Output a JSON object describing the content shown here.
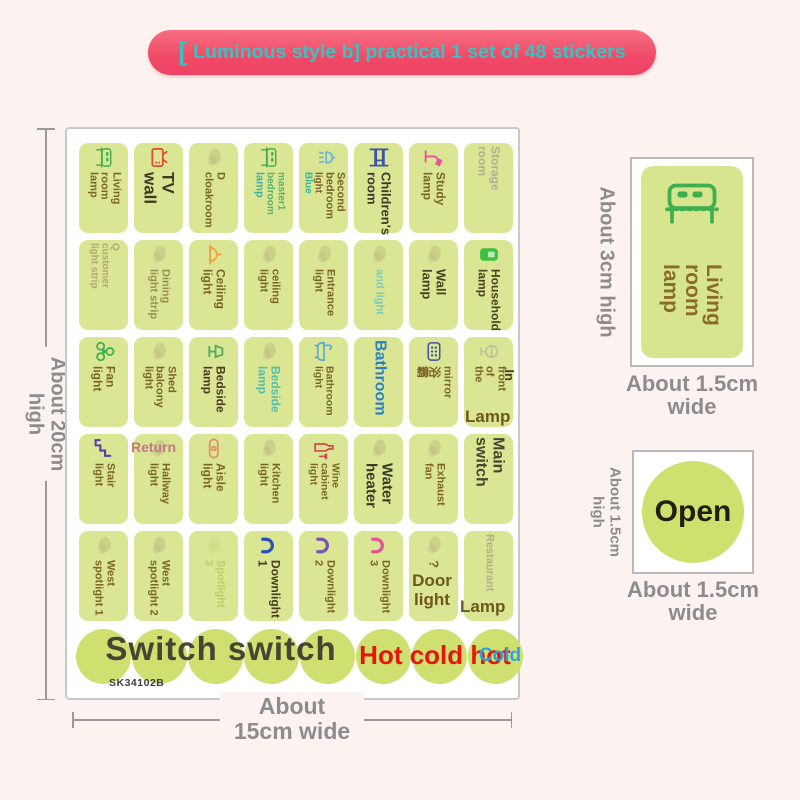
{
  "banner": {
    "bracket": "[",
    "text": "Luminous style b] practical 1 set of 48 stickers",
    "bg": "#ee4163",
    "fg": "#38c2c4"
  },
  "colors": {
    "sticker_bg": "#dae694",
    "circle_bg": "#cfe070",
    "brown": "#7c6426",
    "dark_overlay": "#3c3a26",
    "teal": "#3ab2a4",
    "blue": "#2e7fc0",
    "red": "#e2180e",
    "cold_blue": "#2aa3de",
    "dim_gray": "#8c8c8c"
  },
  "sheet": {
    "code": "SK34102B",
    "stickers": [
      {
        "icon": "bed-icon",
        "icon_color": "#3fae4e",
        "lines": [
          {
            "text": "Living",
            "color": "#7c6426",
            "size": 11
          },
          {
            "text": "room",
            "color": "#7c6426",
            "size": 11
          },
          {
            "text": "lamp",
            "color": "#7c6426",
            "size": 11
          }
        ]
      },
      {
        "icon": "tv-icon",
        "icon_color": "#df4b2d",
        "lines": [
          {
            "text": "TV",
            "color": "#3c3a26",
            "size": 17
          },
          {
            "text": "wall",
            "color": "#3c3a26",
            "size": 17
          }
        ]
      },
      {
        "icon": "faded-icon",
        "icon_color": "#b3a878",
        "lines": [
          {
            "text": "D",
            "color": "#7c6426",
            "size": 11
          },
          {
            "text": "cloakroom",
            "color": "#7c6426",
            "size": 11
          }
        ]
      },
      {
        "icon": "bed-icon",
        "icon_color": "#3fae4e",
        "lines": [
          {
            "text": "master1",
            "color": "#5fb06a",
            "size": 10
          },
          {
            "text": "bedroom",
            "color": "#5fb06a",
            "size": 10
          },
          {
            "text": "lamp",
            "color": "#3ab2a4",
            "size": 11
          }
        ]
      },
      {
        "icon": "shower-icon",
        "icon_color": "#6cb2dc",
        "lines": [
          {
            "text": "Second",
            "color": "#7c6426",
            "size": 11
          },
          {
            "text": "bedroom",
            "color": "#7c6426",
            "size": 11
          },
          {
            "text": "light",
            "color": "#7c6426",
            "size": 10
          },
          {
            "text": "Blue",
            "color": "#3ab2a4",
            "size": 10
          }
        ]
      },
      {
        "icon": "bunkbed-icon",
        "icon_color": "#3d55a8",
        "lines": [
          {
            "text": "Children's",
            "color": "#3c3a26",
            "size": 13
          },
          {
            "text": "room",
            "color": "#3c3a26",
            "size": 13
          }
        ]
      },
      {
        "icon": "desklamp-icon",
        "icon_color": "#e8559a",
        "lines": [
          {
            "text": "Study",
            "color": "#7c6426",
            "size": 12
          },
          {
            "text": "lamp",
            "color": "#7c6426",
            "size": 12
          }
        ]
      },
      {
        "icon": "none",
        "icon_color": "",
        "lines": [
          {
            "text": "Storage",
            "color": "#b5ae95",
            "size": 12
          },
          {
            "text": "room",
            "color": "#b5ae95",
            "size": 12
          }
        ]
      },
      {
        "icon": "none",
        "icon_color": "",
        "lines": [
          {
            "text": "Q",
            "color": "#b3a878",
            "size": 10
          },
          {
            "text": "customer",
            "color": "#b3a878",
            "size": 10
          },
          {
            "text": "light strip",
            "color": "#b3a878",
            "size": 10
          }
        ]
      },
      {
        "icon": "faded-icon",
        "icon_color": "#b3a878",
        "lines": [
          {
            "text": "Dining",
            "color": "#9d8d55",
            "size": 11
          },
          {
            "text": "light strip",
            "color": "#9d8d55",
            "size": 11
          }
        ]
      },
      {
        "icon": "ceilinglamp-icon",
        "icon_color": "#efa13b",
        "lines": [
          {
            "text": "Ceiling",
            "color": "#7c6426",
            "size": 12
          },
          {
            "text": "light",
            "color": "#7c6426",
            "size": 12
          }
        ]
      },
      {
        "icon": "faded-icon",
        "icon_color": "#b3a878",
        "lines": [
          {
            "text": "ceiling",
            "color": "#7c6426",
            "size": 11
          },
          {
            "text": "light",
            "color": "#7c6426",
            "size": 11
          }
        ]
      },
      {
        "icon": "faded-icon",
        "icon_color": "#b3a878",
        "lines": [
          {
            "text": "Entrance",
            "color": "#7c6426",
            "size": 11
          },
          {
            "text": "light",
            "color": "#7c6426",
            "size": 11
          }
        ]
      },
      {
        "icon": "faded-icon",
        "icon_color": "#b3a878",
        "lines": [
          {
            "text": "and light",
            "color": "#7fcabe",
            "size": 11
          }
        ]
      },
      {
        "icon": "faded-icon",
        "icon_color": "#b3a878",
        "lines": [
          {
            "text": "Wall",
            "color": "#4a3f23",
            "size": 13
          },
          {
            "text": "lamp",
            "color": "#4a3f23",
            "size": 13
          }
        ]
      },
      {
        "icon": "switch-icon",
        "icon_color": "#3fbf3f",
        "lines": [
          {
            "text": "Household",
            "color": "#4a3f23",
            "size": 12
          },
          {
            "text": "lamp",
            "color": "#4a3f23",
            "size": 12
          }
        ]
      },
      {
        "icon": "fan-icon",
        "icon_color": "#3fae4e",
        "lines": [
          {
            "text": "Fan",
            "color": "#7c6426",
            "size": 12
          },
          {
            "text": "light",
            "color": "#7c6426",
            "size": 12
          }
        ]
      },
      {
        "icon": "faded-icon",
        "icon_color": "#b3a878",
        "lines": [
          {
            "text": "Shed",
            "color": "#7c6426",
            "size": 11
          },
          {
            "text": "balcony",
            "color": "#7c6426",
            "size": 11
          },
          {
            "text": "light",
            "color": "#7c6426",
            "size": 11
          }
        ]
      },
      {
        "icon": "bedside-icon",
        "icon_color": "#4fae5e",
        "lines": [
          {
            "text": "Bedside",
            "color": "#4a3a20",
            "size": 12
          },
          {
            "text": "lamp",
            "color": "#4a3a20",
            "size": 12
          }
        ]
      },
      {
        "icon": "faded-icon",
        "icon_color": "#b3a878",
        "lines": [
          {
            "text": "Bedside",
            "color": "#52bfae",
            "size": 12
          },
          {
            "text": "lamp",
            "color": "#52bfae",
            "size": 12
          }
        ]
      },
      {
        "icon": "bathtub-icon",
        "icon_color": "#58a8d8",
        "lines": [
          {
            "text": "Bathroom",
            "color": "#7c6426",
            "size": 10.5
          },
          {
            "text": "light",
            "color": "#7c6426",
            "size": 10.5
          }
        ]
      },
      {
        "icon": "none",
        "icon_color": "",
        "lines": [
          {
            "text": "Bathroom",
            "color": "#2e7fc0",
            "size": 16
          }
        ]
      },
      {
        "icon": "heater-icon",
        "icon_color": "#3d55a8",
        "lines": [
          {
            "text": "mirror",
            "color": "#7c6426",
            "size": 11
          },
          {
            "text": "浴",
            "color": "#7c6426",
            "size": 12
          },
          {
            "text": "霸",
            "color": "#7c6426",
            "size": 12
          }
        ]
      },
      {
        "icon": "globe-icon",
        "icon_color": "#a9a49a",
        "lines": [
          {
            "text": "front",
            "color": "#7c6426",
            "size": 11
          },
          {
            "text": "of",
            "color": "#7c6426",
            "size": 11
          },
          {
            "text": "the",
            "color": "#7c6426",
            "size": 11
          }
        ]
      },
      {
        "icon": "stairs-icon",
        "icon_color": "#5b3da6",
        "lines": [
          {
            "text": "Stair",
            "color": "#7c6426",
            "size": 11
          },
          {
            "text": "light",
            "color": "#7c6426",
            "size": 11
          }
        ]
      },
      {
        "icon": "faded-icon",
        "icon_color": "#b3a878",
        "lines": [
          {
            "text": "Hallway",
            "color": "#7c6426",
            "size": 11
          },
          {
            "text": "light",
            "color": "#7c6426",
            "size": 11
          }
        ]
      },
      {
        "icon": "aisle-icon",
        "icon_color": "#e28d68",
        "lines": [
          {
            "text": "Aisle",
            "color": "#7c6426",
            "size": 12
          },
          {
            "text": "light",
            "color": "#7c6426",
            "size": 12
          }
        ]
      },
      {
        "icon": "faded-icon",
        "icon_color": "#b3a878",
        "lines": [
          {
            "text": "Kitchen",
            "color": "#7c6426",
            "size": 11
          },
          {
            "text": "light",
            "color": "#7c6426",
            "size": 11
          }
        ]
      },
      {
        "icon": "wine-icon",
        "icon_color": "#d4484f",
        "lines": [
          {
            "text": "Wine",
            "color": "#7c6426",
            "size": 10.5
          },
          {
            "text": "cabinet",
            "color": "#7c6426",
            "size": 10.5
          },
          {
            "text": "light",
            "color": "#7c6426",
            "size": 10.5
          }
        ]
      },
      {
        "icon": "faded-icon",
        "icon_color": "#b3a878",
        "lines": [
          {
            "text": "Water",
            "color": "#3c3a26",
            "size": 15
          },
          {
            "text": "heater",
            "color": "#3c3a26",
            "size": 15
          }
        ]
      },
      {
        "icon": "faded-icon",
        "icon_color": "#b3a878",
        "lines": [
          {
            "text": "Exhaust",
            "color": "#7c6426",
            "size": 11
          },
          {
            "text": "fan",
            "color": "#7c6426",
            "size": 11
          }
        ]
      },
      {
        "icon": "none",
        "icon_color": "",
        "lines": [
          {
            "text": "Main",
            "color": "#4a4430",
            "size": 16
          },
          {
            "text": "switch",
            "color": "#4a4430",
            "size": 16
          }
        ]
      },
      {
        "icon": "faded-icon",
        "icon_color": "#b3a878",
        "lines": [
          {
            "text": "West",
            "color": "#7c6426",
            "size": 11
          },
          {
            "text": "spotlight 1",
            "color": "#7c6426",
            "size": 11
          }
        ]
      },
      {
        "icon": "faded-icon",
        "icon_color": "#b3a878",
        "lines": [
          {
            "text": "West",
            "color": "#7c6426",
            "size": 11
          },
          {
            "text": "spotlight 2",
            "color": "#7c6426",
            "size": 11
          }
        ]
      },
      {
        "icon": "faded-icon",
        "icon_color": "#c3d57a",
        "lines": [
          {
            "text": "Spotlight",
            "color": "#b9cf6e",
            "size": 11
          },
          {
            "text": "3",
            "color": "#b9cf6e",
            "size": 11
          }
        ]
      },
      {
        "icon": "downlight-icon",
        "icon_color": "#2a52b8",
        "lines": [
          {
            "text": "Downlight",
            "color": "#4a3a20",
            "size": 12
          },
          {
            "text": "1",
            "color": "#4a3a20",
            "size": 12
          }
        ]
      },
      {
        "icon": "downlight-icon",
        "icon_color": "#7a55b0",
        "lines": [
          {
            "text": "Downlight",
            "color": "#7c6426",
            "size": 11
          },
          {
            "text": "2",
            "color": "#7c6426",
            "size": 11
          }
        ]
      },
      {
        "icon": "downlight-icon",
        "icon_color": "#e0559a",
        "lines": [
          {
            "text": "Downlight",
            "color": "#7c6426",
            "size": 11
          },
          {
            "text": "3",
            "color": "#7c6426",
            "size": 11
          }
        ]
      },
      {
        "icon": "faded-icon",
        "icon_color": "#b3a878",
        "lines": [
          {
            "text": "?",
            "color": "#7c6426",
            "size": 13
          }
        ]
      },
      {
        "icon": "none",
        "icon_color": "",
        "lines": [
          {
            "text": "Restaurant",
            "color": "#b3ac8e",
            "size": 11
          }
        ]
      }
    ],
    "circle_count": 8,
    "overlays": [
      {
        "id": "return",
        "text": "Return",
        "color": "#c57788",
        "size": 14
      },
      {
        "id": "door-light",
        "text": "Door\nlight",
        "color": "#6d581c",
        "size": 17
      },
      {
        "id": "lamp-mid",
        "text": "Lamp",
        "color": "#6d581c",
        "size": 17
      },
      {
        "id": "in-margin",
        "text": "In",
        "color": "#4a3f23",
        "size": 13
      },
      {
        "id": "lamp-bottom",
        "text": "Lamp",
        "color": "#6d581c",
        "size": 17
      },
      {
        "id": "switch-label",
        "text": "Switch switch",
        "color": "#474433",
        "size": 33
      },
      {
        "id": "hot-label",
        "text": "Hot cold hot",
        "color": "#e2180e",
        "size": 26
      },
      {
        "id": "cold-label",
        "text": "Cold",
        "color": "#2aa3de",
        "size": 19
      },
      {
        "id": "sheet-code",
        "text": "SK34102B",
        "color": "#3f3f3f",
        "size": 10.5
      }
    ]
  },
  "dims": {
    "height": {
      "l1": "About 20cm",
      "l2": "high"
    },
    "width": {
      "l1": "About",
      "l2": "15cm wide"
    }
  },
  "detail_large": {
    "icon": "bed-icon",
    "icon_color": "#3fae4e",
    "lines": [
      {
        "text": "Living",
        "color": "#8a6b28",
        "size": 21
      },
      {
        "text": "room",
        "color": "#8a6b28",
        "size": 21
      },
      {
        "text": "lamp",
        "color": "#8a6b28",
        "size": 21
      }
    ],
    "left_label": "About 3cm high",
    "bottom_l1": "About 1.5cm",
    "bottom_l2": "wide"
  },
  "detail_circle": {
    "text": "Open",
    "text_color": "#241d12",
    "left_l1": "About 1.5cm",
    "left_l2": "high",
    "bottom_l1": "About 1.5cm",
    "bottom_l2": "wide"
  }
}
